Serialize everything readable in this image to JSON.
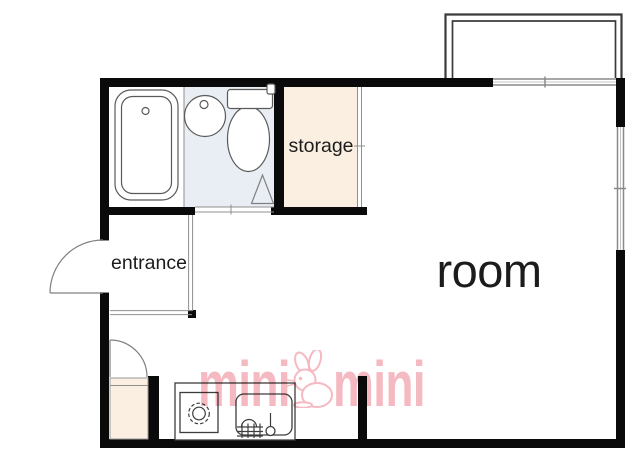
{
  "page": {
    "type": "apartment-floor-plan"
  },
  "labels": {
    "room": "room",
    "storage": "storage",
    "entrance": "entrance"
  },
  "watermark": {
    "left": "mini",
    "right": "mini",
    "mascot": "rabbit-icon"
  },
  "fixtures": {
    "bathtub": "bathtub-icon",
    "washbasin": "washbasin-icon",
    "toilet": "toilet-icon",
    "gas_stove": "gas-stove-icon",
    "kitchen_sink": "kitchen-sink-icon",
    "entrance_door": "swing-door",
    "closet_door": "swing-door",
    "toilet_door": "folding-door",
    "storage_door": "sliding-door",
    "balcony": "balcony",
    "top_window": "sliding-window",
    "right_window": "sliding-window"
  },
  "colors": {
    "wall": "#0a0a0a",
    "washroom_fill": "#e9eef4",
    "storage_fill": "#fbefe2",
    "fixture_line": "#5a5a5a",
    "thin_line": "#8f8f8f",
    "balcony_line": "#3b3b3b",
    "window_line": "#8a8a8a",
    "label_text": "#1c1c1c",
    "watermark_pink": "#f5b9c1"
  }
}
